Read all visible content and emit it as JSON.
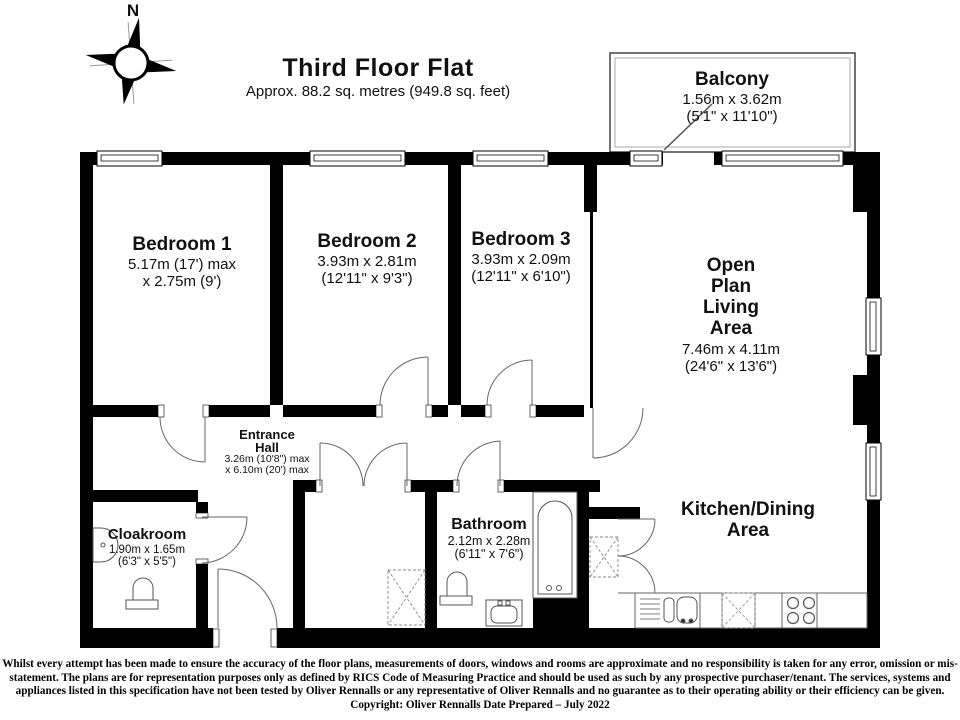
{
  "title": {
    "name": "Third Floor Flat",
    "area": "Approx. 88.2 sq. metres (949.8 sq. feet)"
  },
  "compass": {
    "north_label": "N"
  },
  "rooms": {
    "balcony": {
      "name": "Balcony",
      "dim_metric": "1.56m x 3.62m",
      "dim_imperial": "(5'1\" x 11'10\")"
    },
    "bedroom1": {
      "name": "Bedroom 1",
      "dim_metric": "5.17m (17') max",
      "dim_imperial": "x 2.75m (9')"
    },
    "bedroom2": {
      "name": "Bedroom 2",
      "dim_metric": "3.93m x 2.81m",
      "dim_imperial": "(12'11\" x 9'3\")"
    },
    "bedroom3": {
      "name": "Bedroom 3",
      "dim_metric": "3.93m x 2.09m",
      "dim_imperial": "(12'11\" x 6'10\")"
    },
    "open_plan": {
      "line1": "Open",
      "line2": "Plan",
      "line3": "Living",
      "line4": "Area",
      "dim_metric": "7.46m x 4.11m",
      "dim_imperial": "(24'6\" x 13'6\")"
    },
    "entrance_hall": {
      "line1": "Entrance",
      "line2": "Hall",
      "dim_metric": "3.26m (10'8\") max",
      "dim_imperial": "x 6.10m (20') max"
    },
    "cloakroom": {
      "name": "Cloakroom",
      "dim_metric": "1.90m x 1.65m",
      "dim_imperial": "(6'3\" x 5'5\")"
    },
    "bathroom": {
      "name": "Bathroom",
      "dim_metric": "2.12m x 2.28m",
      "dim_imperial": "(6'11\" x 7'6\")"
    },
    "kitchen": {
      "line1": "Kitchen/Dining",
      "line2": "Area"
    }
  },
  "disclaimer": "Whilst every attempt has been made to ensure the accuracy of the floor plans, measurements of doors, windows and rooms are approximate and no responsibility is taken for any error, omission or mis-statement. The plans are for representation purposes only as defined by RICS Code of Measuring Practice and should be used as such by any prospective purchaser/tenant. The services, systems and appliances listed in this specification have not been tested by Oliver Rennalls or any representative of Oliver Rennalls and no guarantee as to their operating ability or their efficiency can be given. Copyright: Oliver Rennalls Date Prepared – July 2022",
  "colors": {
    "wall": "#000000",
    "background": "#ffffff",
    "line": "#666666"
  }
}
